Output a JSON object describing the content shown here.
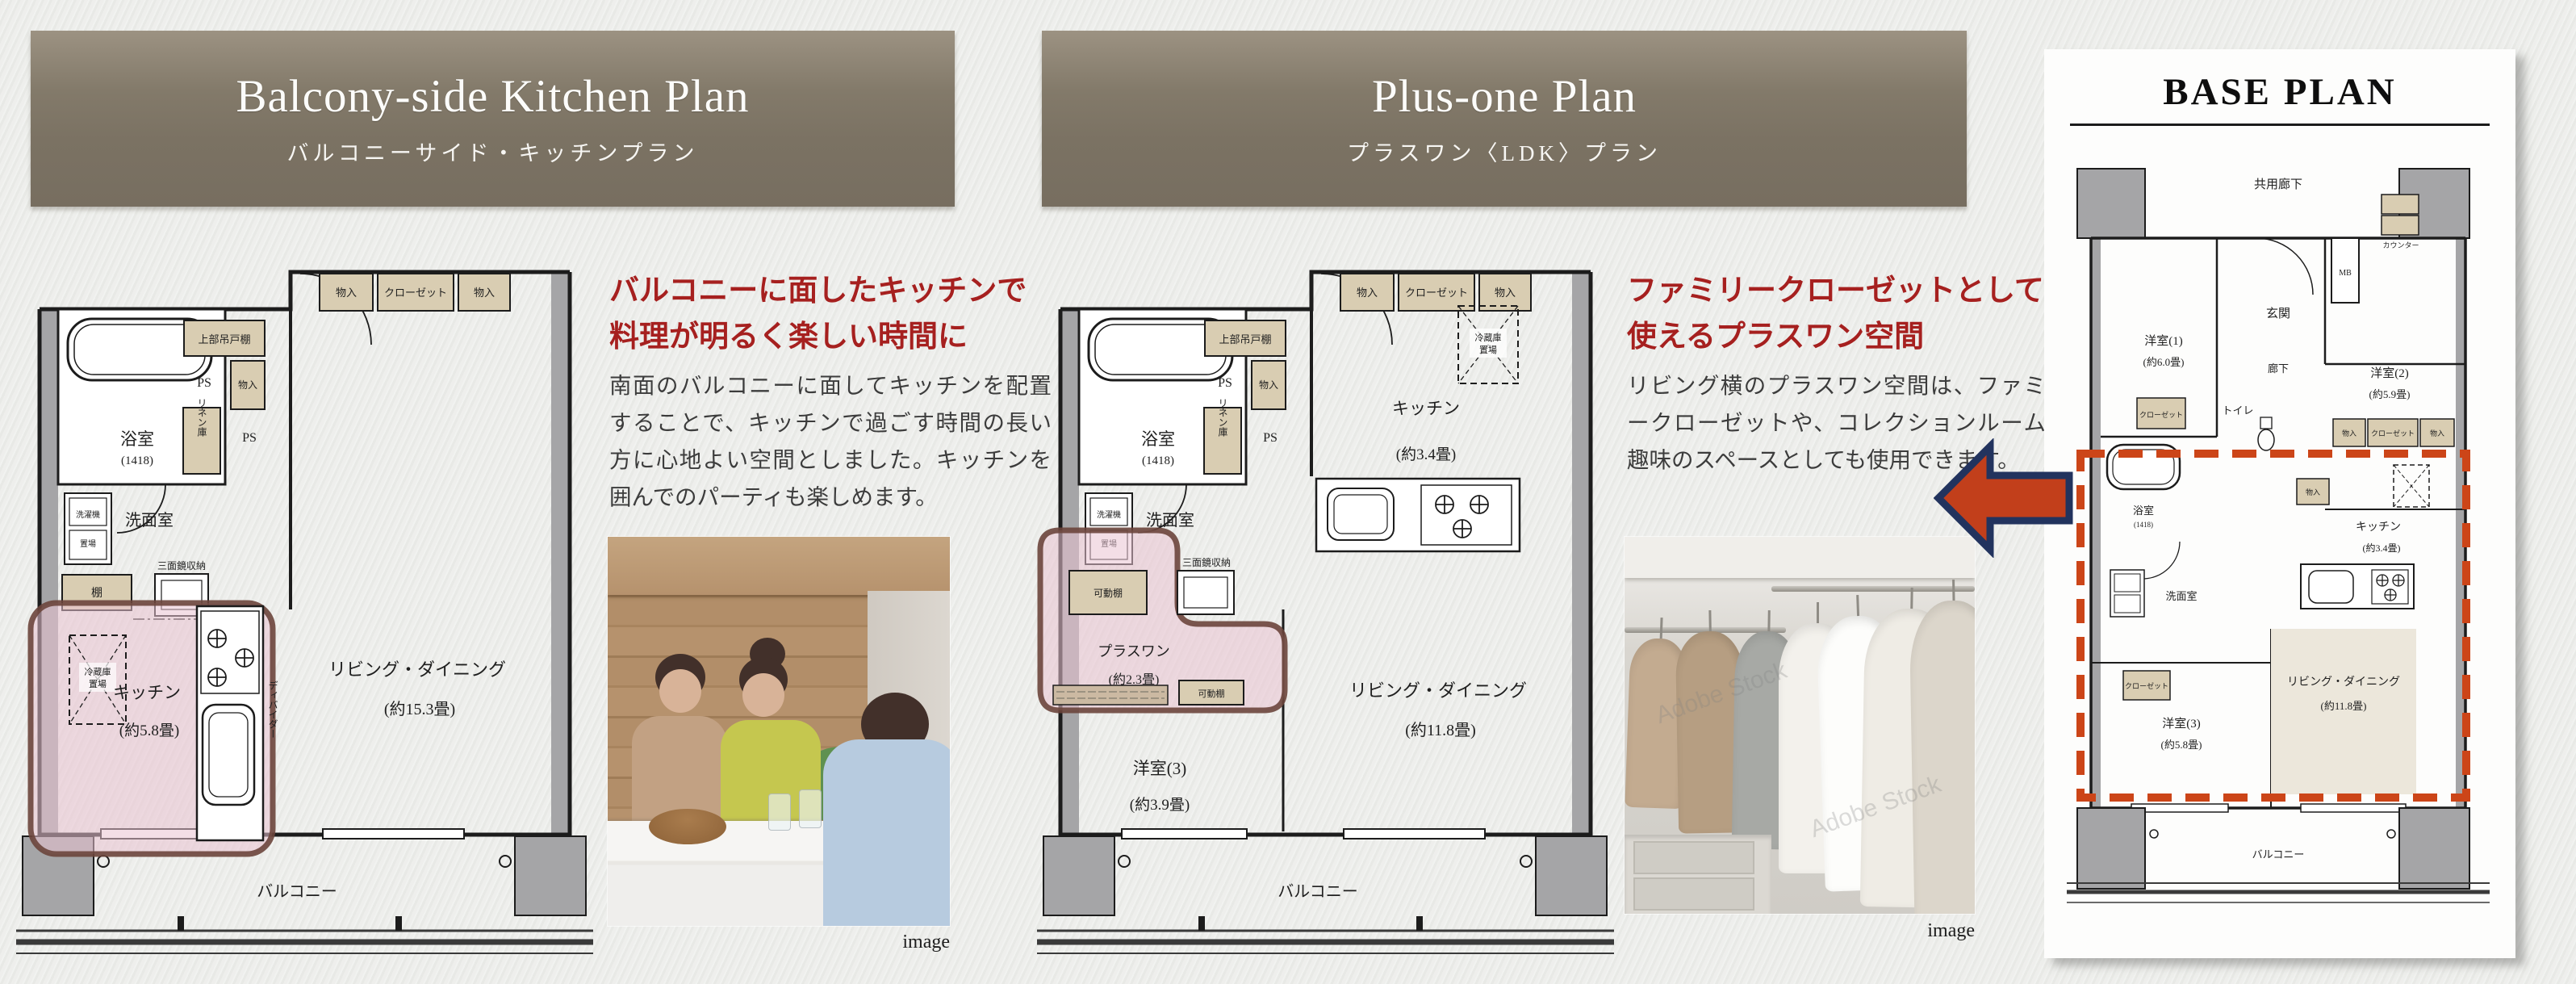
{
  "banner_left": {
    "title": "Balcony-side Kitchen Plan",
    "subtitle": "バルコニーサイド・キッチンプラン"
  },
  "banner_center": {
    "title": "Plus-one Plan",
    "subtitle": "プラスワン〈LDK〉プラン"
  },
  "col_left": {
    "heading1": "バルコニーに面したキッチンで",
    "heading2": "料理が明るく楽しい時間に",
    "body": "南面のバルコニーに面してキッチンを配置することで、キッチンで過ごす時間の長い方に心地よい空間としました。キッチンを囲んでのパーティも楽しめます。",
    "caption": "image"
  },
  "col_center": {
    "heading1": "ファミリークローゼットとしても",
    "heading2": "使えるプラスワン空間",
    "body": "リビング横のプラスワン空間は、ファミリークローゼットや、コレクションルーム、趣味のスペースとしても使用できます。",
    "caption": "image",
    "watermark": "Adobe Stock"
  },
  "labels": {
    "bath": "浴室",
    "bath_size": "(1418)",
    "ps": "PS",
    "monoire": "物入",
    "closet": "クローゼット",
    "upper_cabinet": "上部吊戸棚",
    "linen": "リネン庫",
    "washroom": "洗面室",
    "washer1": "洗濯機",
    "washer2": "置場",
    "shelf": "棚",
    "mirror": "三面鏡収納",
    "divider": "ディバイダー",
    "fridge1": "冷蔵庫",
    "fridge2": "置場",
    "kitchen": "キッチン",
    "living": "リビング・ダイニング",
    "balcony": "バルコニー",
    "movable": "可動棚",
    "plusone": "プラスワン"
  },
  "plan_left": {
    "kitchen_size": "(約5.8畳)",
    "living_size": "(約15.3畳)"
  },
  "plan_center": {
    "kitchen_size": "(約3.4畳)",
    "plusone_size": "(約2.3畳)",
    "room3": "洋室(3)",
    "room3_size": "(約3.9畳)",
    "living_size": "(約11.8畳)"
  },
  "base_plan": {
    "title": "BASE PLAN",
    "corridor_shared": "共用廊下",
    "entrance": "玄関",
    "mb": "MB",
    "counter": "カウンター",
    "room1": "洋室(1)",
    "room1_size": "(約6.0畳)",
    "room2": "洋室(2)",
    "room2_size": "(約5.9畳)",
    "corridor": "廊下",
    "toilet": "トイレ",
    "room3": "洋室(3)",
    "room3_size": "(約5.8畳)",
    "kitchen_size": "(約3.4畳)",
    "living_size": "(約11.8畳)"
  }
}
